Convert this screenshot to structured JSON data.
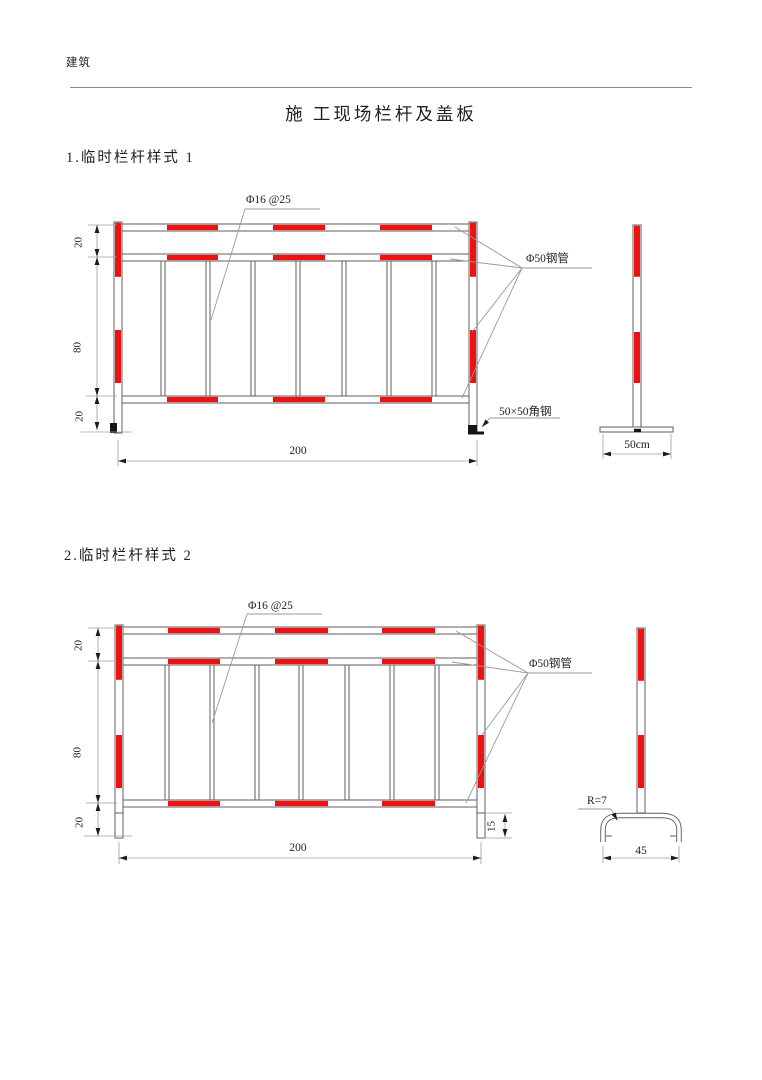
{
  "header": {
    "doc_label": "建筑",
    "title": "施 工现场栏杆及盖板"
  },
  "colors": {
    "red": "#ee1111",
    "line": "#5f5f5f",
    "dimc": "#9f9f9f",
    "text": "#1f1f1f"
  },
  "section1": {
    "heading": "1.临时栏杆样式 1",
    "front_view": {
      "rebar_label": "Φ16 @25",
      "pipe_label": "Φ50钢管",
      "angle_label": "50×50角钢",
      "dim_top": "20",
      "dim_middle": "80",
      "dim_bottom": "20",
      "dim_width": "200"
    },
    "side_view": {
      "dim_base": "50cm"
    }
  },
  "section2": {
    "heading": "2.临时栏杆样式 2",
    "front_view": {
      "rebar_label": "Φ16 @25",
      "pipe_label": "Φ50钢管",
      "dim_top": "20",
      "dim_middle": "80",
      "dim_bottom": "20",
      "dim_width": "200",
      "dim_leg": "15"
    },
    "side_view": {
      "radius_label": "R=7",
      "dim_base": "45"
    }
  }
}
